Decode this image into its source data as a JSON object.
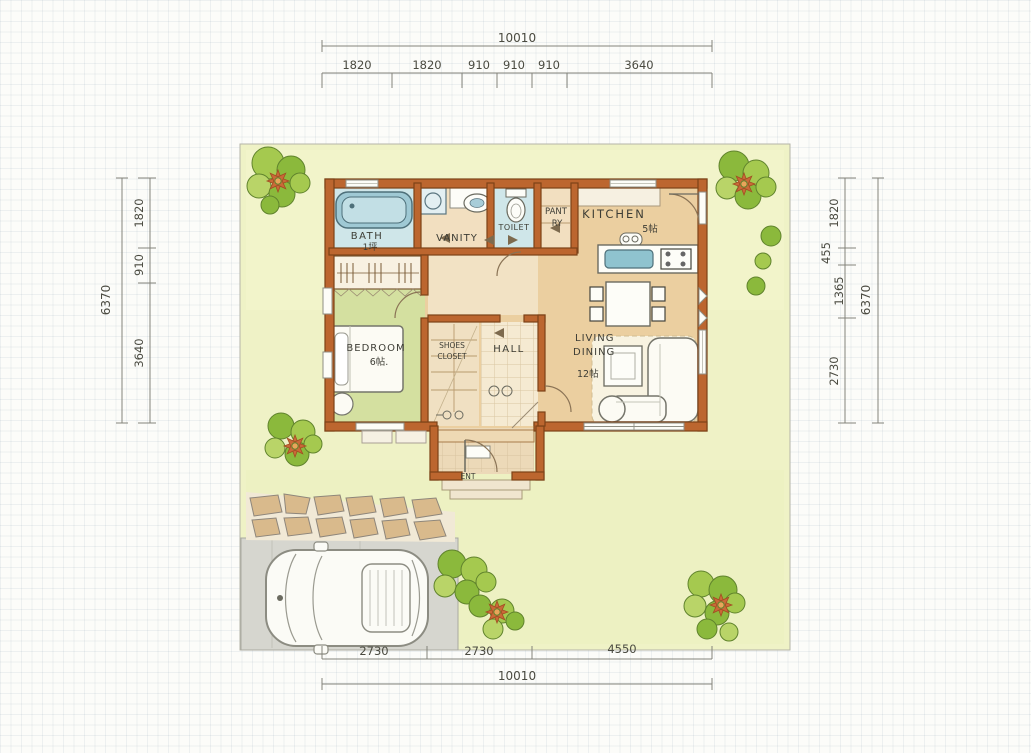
{
  "plan": {
    "rooms": {
      "bath": {
        "name": "BATH",
        "size": "1坪"
      },
      "vanity": {
        "name": "VANITY"
      },
      "toilet": {
        "name": "TOILET"
      },
      "pantry": {
        "line1": "PANT",
        "line2": "RY"
      },
      "kitchen": {
        "name": "KITCHEN",
        "size": "5帖"
      },
      "bedroom": {
        "name": "BEDROOM",
        "size": "6帖."
      },
      "shoes_closet": {
        "line1": "SHOES",
        "line2": "CLOSET"
      },
      "hall": {
        "name": "HALL"
      },
      "living_dining": {
        "line1": "LIVING",
        "line2": "DINING",
        "size": "12帖"
      },
      "entrance": {
        "name": "ENT"
      }
    },
    "dimensions": {
      "top": {
        "total": "10010",
        "segments": [
          "1820",
          "1820",
          "910",
          "910",
          "910",
          "3640"
        ]
      },
      "bottom": {
        "total": "10010",
        "segments": [
          "2730",
          "2730",
          "4550"
        ]
      },
      "left": {
        "total": "6370",
        "segments": [
          "1820",
          "910",
          "3640"
        ]
      },
      "right": {
        "total": "6370",
        "segments": [
          "1820",
          "455",
          "1365",
          "2730"
        ]
      }
    },
    "colors": {
      "wall": "#bc662f",
      "wall_outline": "#7c4318",
      "lawn": "#eff2c6",
      "wood_floor": "#ebcfa0",
      "tile_floor": "#f3e7cd",
      "bedroom_floor": "#d4e0a0",
      "water_fixture": "#9fc9d4",
      "tree_green": "#8bb93c",
      "flower_orange": "#c96a38",
      "driveway_gray": "#d6d6cf",
      "stone_tan": "#d9ba8c",
      "pencil_gray": "#83837a"
    }
  }
}
